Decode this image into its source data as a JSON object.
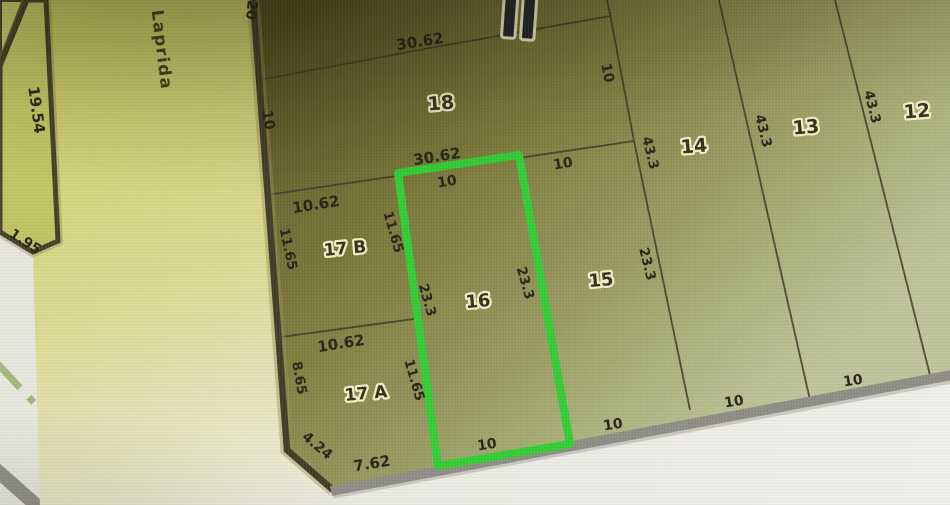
{
  "map": {
    "type": "cadastral-lot-map",
    "highlight": {
      "lot": "16",
      "color": "#33cd36"
    },
    "street": {
      "text": "Laprida",
      "x": 161,
      "y": 50,
      "rot": 83,
      "size": 16.5
    },
    "block_numeral_icon": {
      "name": "roman-numeral-ii-icon",
      "glyph": "II"
    },
    "colors": {
      "block_dark": "#524f1e",
      "block_light": "#bfc49c",
      "street_band": "#d0d066",
      "pavement": "#eae8e4",
      "edge_dark": "#403d28",
      "edge_gray": "#8f8e86",
      "centerline_green": "#9cb173"
    },
    "lot_labels": [
      {
        "text": "18",
        "x": 441,
        "y": 104,
        "rot": -5,
        "size": 19
      },
      {
        "text": "14",
        "x": 694,
        "y": 147,
        "rot": -5,
        "size": 19
      },
      {
        "text": "13",
        "x": 806,
        "y": 128,
        "rot": -5,
        "size": 19
      },
      {
        "text": "12",
        "x": 917,
        "y": 112,
        "rot": -5,
        "size": 19
      },
      {
        "text": "15",
        "x": 601,
        "y": 281,
        "rot": -5,
        "size": 18
      },
      {
        "text": "16",
        "x": 478,
        "y": 302,
        "rot": -5,
        "size": 18
      },
      {
        "text": "17 B",
        "x": 345,
        "y": 249,
        "rot": -5,
        "size": 17
      },
      {
        "text": "17 A",
        "x": 366,
        "y": 394,
        "rot": -5,
        "size": 17
      }
    ],
    "dimension_labels": [
      {
        "text": "30.62",
        "x": 420,
        "y": 42,
        "rot": -9,
        "size": 15
      },
      {
        "text": "30.62",
        "x": 437,
        "y": 157,
        "rot": -9,
        "size": 15
      },
      {
        "text": "10",
        "x": 447,
        "y": 182,
        "rot": -9,
        "size": 14
      },
      {
        "text": "10",
        "x": 563,
        "y": 164,
        "rot": -9,
        "size": 14
      },
      {
        "text": "10",
        "x": 268,
        "y": 120,
        "rot": 80,
        "size": 14
      },
      {
        "text": "20",
        "x": 251,
        "y": 10,
        "rot": 96,
        "size": 14
      },
      {
        "text": "10",
        "x": 607,
        "y": 73,
        "rot": 78,
        "size": 14
      },
      {
        "text": "10.62",
        "x": 316,
        "y": 205,
        "rot": -9,
        "size": 15
      },
      {
        "text": "11.65",
        "x": 288,
        "y": 249,
        "rot": 78,
        "size": 13.5
      },
      {
        "text": "11.65",
        "x": 393,
        "y": 232,
        "rot": 74,
        "size": 13.5
      },
      {
        "text": "10.62",
        "x": 341,
        "y": 344,
        "rot": -9,
        "size": 15
      },
      {
        "text": "8.65",
        "x": 299,
        "y": 378,
        "rot": 80,
        "size": 13.5
      },
      {
        "text": "11.65",
        "x": 414,
        "y": 380,
        "rot": 74,
        "size": 13.5
      },
      {
        "text": "23.3",
        "x": 427,
        "y": 300,
        "rot": 74,
        "size": 13.5
      },
      {
        "text": "23.3",
        "x": 525,
        "y": 283,
        "rot": 74,
        "size": 13.5
      },
      {
        "text": "23.3",
        "x": 647,
        "y": 264,
        "rot": 76,
        "size": 13.5
      },
      {
        "text": "43.3",
        "x": 650,
        "y": 153,
        "rot": 76,
        "size": 13.5
      },
      {
        "text": "43.3",
        "x": 763,
        "y": 131,
        "rot": 76,
        "size": 13.5
      },
      {
        "text": "43.3",
        "x": 872,
        "y": 107,
        "rot": 76,
        "size": 13.5
      },
      {
        "text": "4.24",
        "x": 317,
        "y": 446,
        "rot": 40,
        "size": 14
      },
      {
        "text": "7.62",
        "x": 372,
        "y": 464,
        "rot": -9,
        "size": 15
      },
      {
        "text": "10",
        "x": 487,
        "y": 445,
        "rot": -9,
        "size": 14
      },
      {
        "text": "10",
        "x": 613,
        "y": 425,
        "rot": -9,
        "size": 14
      },
      {
        "text": "10",
        "x": 734,
        "y": 402,
        "rot": -9,
        "size": 14
      },
      {
        "text": "10",
        "x": 853,
        "y": 381,
        "rot": -9,
        "size": 14
      },
      {
        "text": "19.54",
        "x": 36,
        "y": 110,
        "rot": 82,
        "size": 15
      },
      {
        "text": "1.95",
        "x": 25,
        "y": 242,
        "rot": 33,
        "size": 14
      }
    ]
  }
}
